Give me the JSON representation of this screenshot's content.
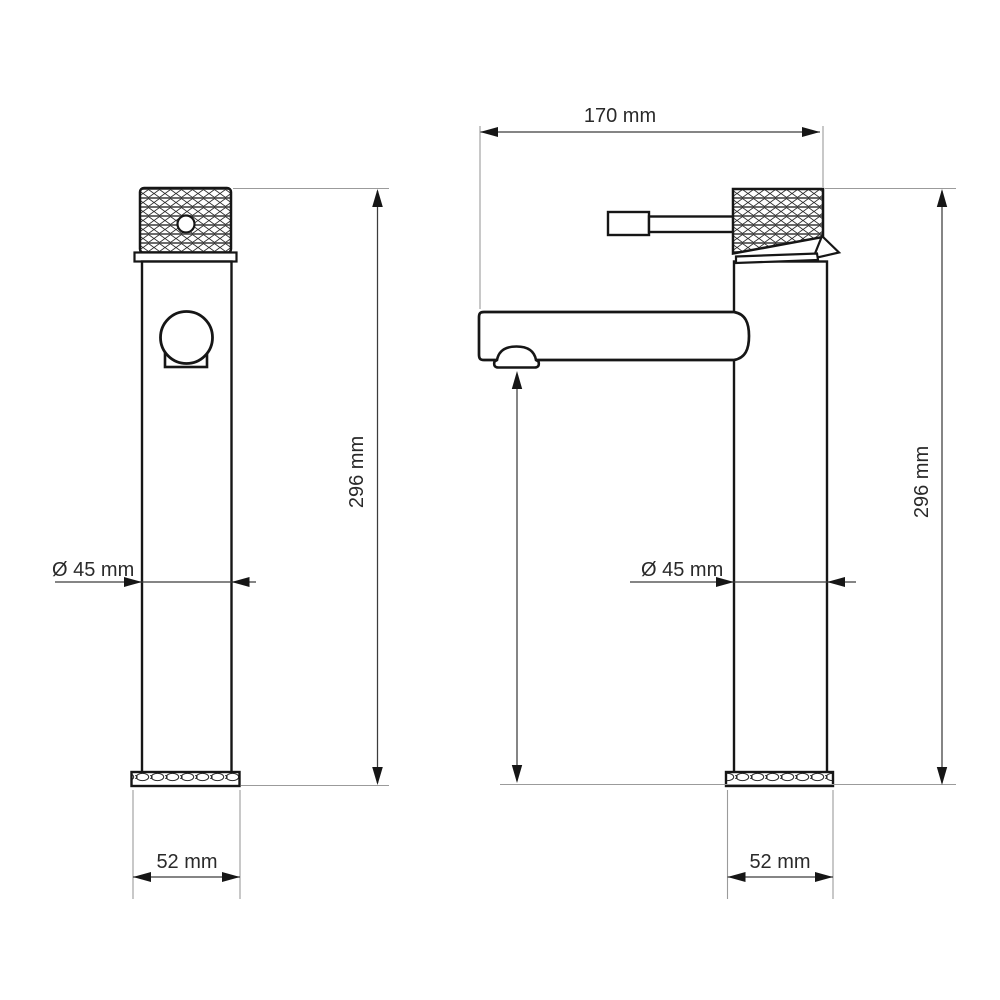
{
  "front_view": {
    "height_label": "296 mm",
    "diameter_label": "Ø 45 mm",
    "base_width_label": "52 mm"
  },
  "side_view": {
    "spout_reach_label": "170 mm",
    "height_label": "296 mm",
    "diameter_label": "Ø 45 mm",
    "base_width_label": "52 mm"
  },
  "colors": {
    "outline": "#161616",
    "dimension_line": "#3c3c3c",
    "extension_line": "#9b9b9b",
    "background": "#ffffff"
  }
}
